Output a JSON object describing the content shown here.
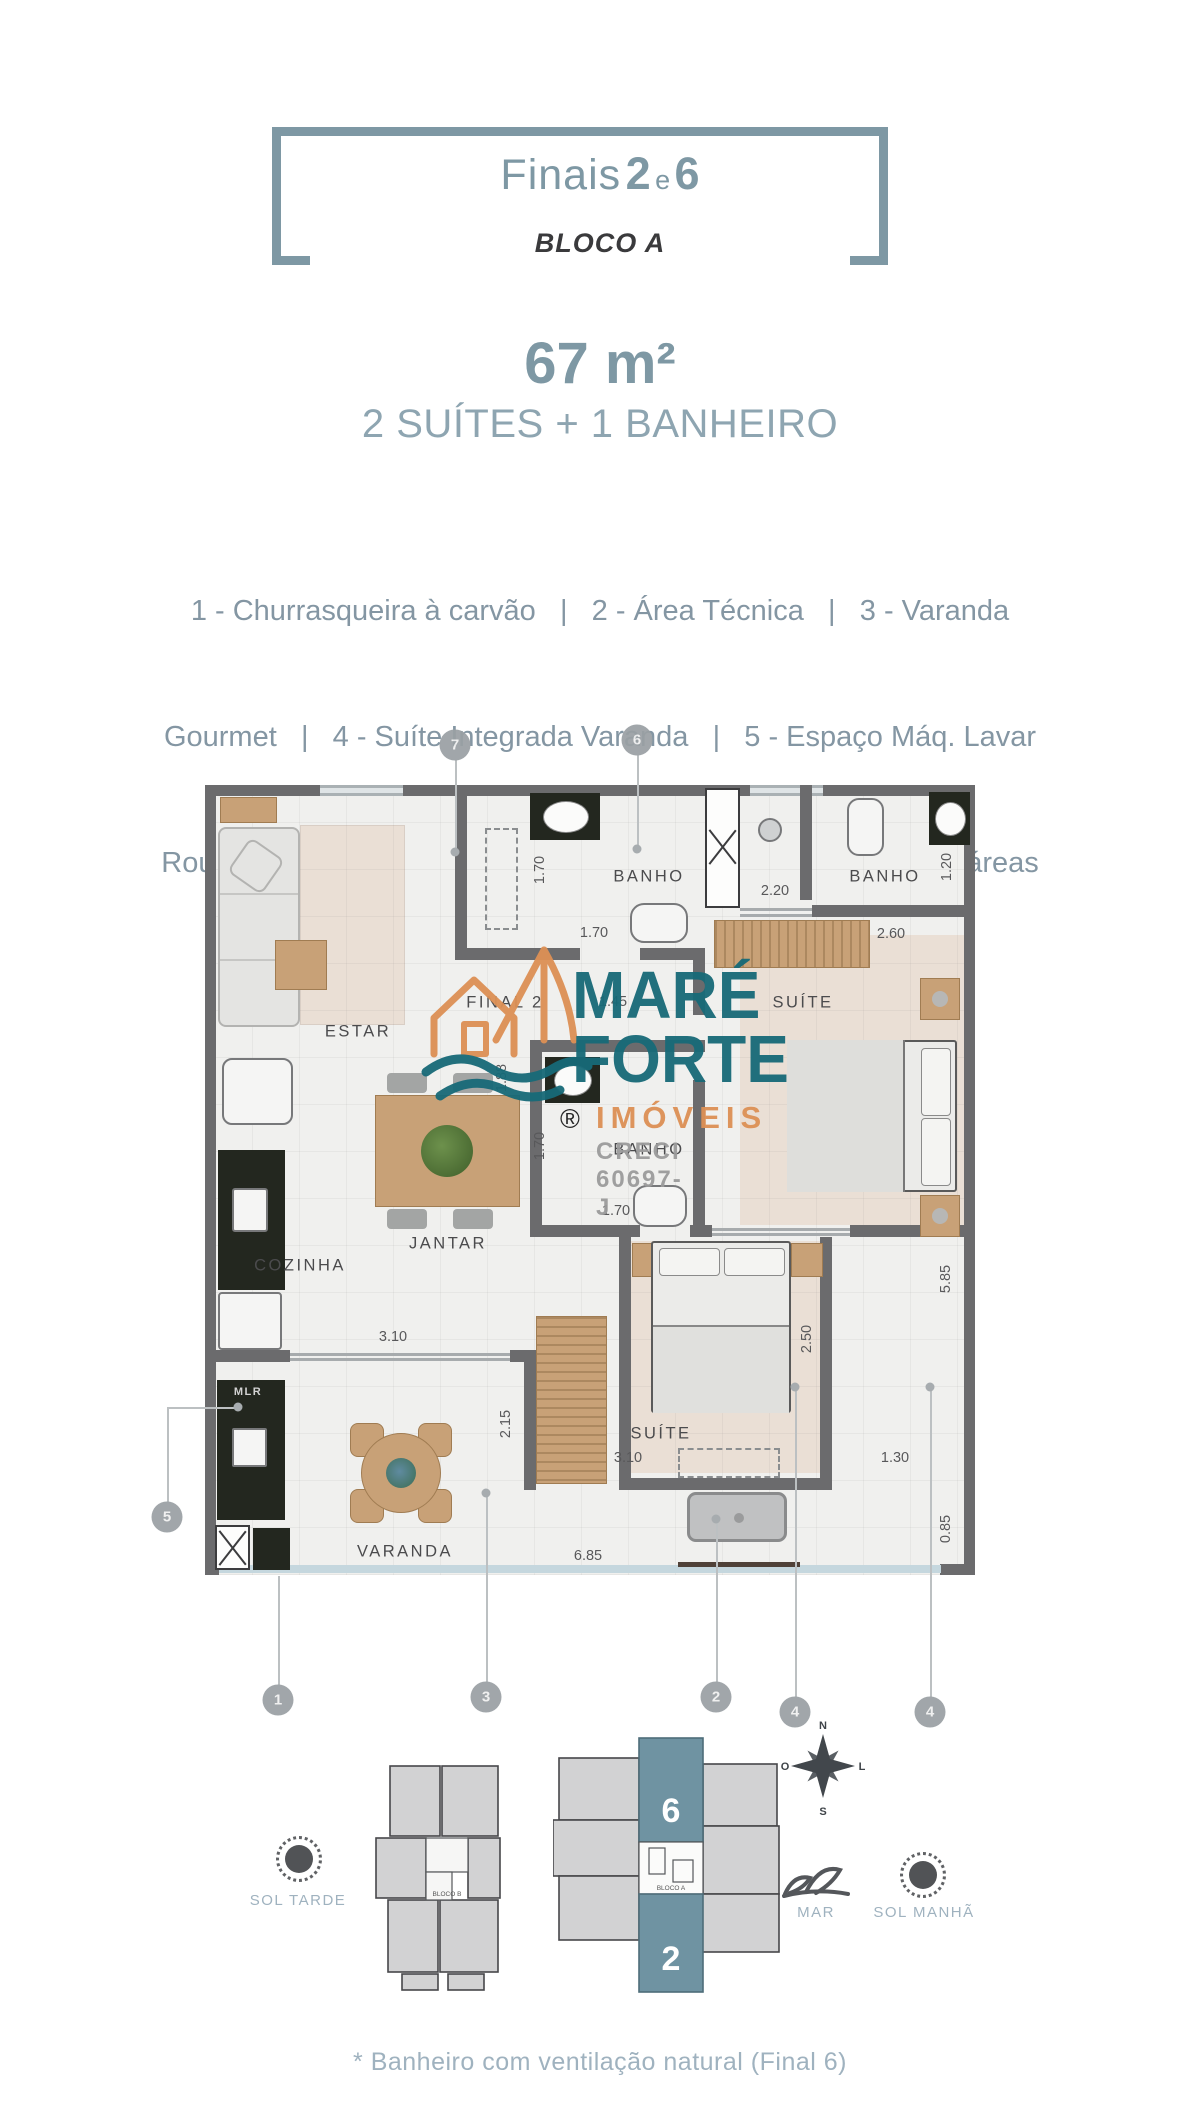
{
  "header": {
    "title_pre": "Finais",
    "title_n1": "2",
    "title_mid": "e",
    "title_n2": "6",
    "block": "BLOCO A",
    "area": "67 m²",
    "typology": "2 SUÍTES + 1 BANHEIRO",
    "accent_color": "#7e98a4"
  },
  "legend": {
    "lines": [
      "1 - Churrasqueira à carvão   |   2 - Área Técnica   |   3 - Varanda",
      "Gourmet   |   4 - Suíte Integrada Varanda   |   5 - Espaço Máq. Lavar",
      "Roupa | 6 - Banheiro Completo* | 7 - Porcelanato em todas as áreas"
    ]
  },
  "floorplan": {
    "rooms": [
      {
        "t": "ESTAR",
        "x": 358,
        "y": 1032
      },
      {
        "t": "BANHO",
        "x": 649,
        "y": 877
      },
      {
        "t": "BANHO",
        "x": 885,
        "y": 877
      },
      {
        "t": "SUÍTE",
        "x": 803,
        "y": 1003
      },
      {
        "t": "FINAL 2",
        "x": 505,
        "y": 1003
      },
      {
        "t": "BANHO",
        "x": 649,
        "y": 1150
      },
      {
        "t": "JANTAR",
        "x": 448,
        "y": 1244
      },
      {
        "t": "COZINHA",
        "x": 300,
        "y": 1266
      },
      {
        "t": "SUÍTE",
        "x": 661,
        "y": 1434
      },
      {
        "t": "VARANDA",
        "x": 405,
        "y": 1552
      },
      {
        "t": "MLR",
        "x": 248,
        "y": 1392,
        "k": "inv"
      }
    ],
    "dims": [
      {
        "t": "1.70",
        "x": 540,
        "y": 870,
        "v": 1
      },
      {
        "t": "1.70",
        "x": 594,
        "y": 933
      },
      {
        "t": "2.20",
        "x": 775,
        "y": 891
      },
      {
        "t": "1.20",
        "x": 947,
        "y": 867,
        "v": 1
      },
      {
        "t": "2.60",
        "x": 891,
        "y": 934
      },
      {
        "t": "1.45",
        "x": 613,
        "y": 1002
      },
      {
        "t": "1.88",
        "x": 502,
        "y": 1078,
        "v": 1
      },
      {
        "t": "1.70",
        "x": 540,
        "y": 1146,
        "v": 1
      },
      {
        "t": "1.70",
        "x": 616,
        "y": 1211
      },
      {
        "t": "3.10",
        "x": 393,
        "y": 1337
      },
      {
        "t": "2.15",
        "x": 506,
        "y": 1424,
        "v": 1
      },
      {
        "t": "3.10",
        "x": 628,
        "y": 1458
      },
      {
        "t": "1.30",
        "x": 895,
        "y": 1458
      },
      {
        "t": "2.50",
        "x": 807,
        "y": 1339,
        "v": 1
      },
      {
        "t": "5.85",
        "x": 946,
        "y": 1279,
        "v": 1
      },
      {
        "t": "0.85",
        "x": 946,
        "y": 1529,
        "v": 1
      },
      {
        "t": "6.85",
        "x": 588,
        "y": 1556
      }
    ],
    "callouts": [
      {
        "n": "7",
        "cx": 455,
        "cy": 745,
        "segs": [
          [
            455,
            760,
            455,
            852
          ]
        ],
        "dot": [
          455,
          852
        ]
      },
      {
        "n": "6",
        "cx": 637,
        "cy": 740,
        "segs": [
          [
            637,
            755,
            637,
            849
          ]
        ],
        "dot": [
          637,
          849
        ]
      },
      {
        "n": "5",
        "cx": 167,
        "cy": 1517,
        "segs": [
          [
            167,
            1407,
            167,
            1502
          ],
          [
            167,
            1407,
            238,
            1407
          ]
        ],
        "dot": [
          238,
          1407
        ]
      },
      {
        "n": "1",
        "cx": 278,
        "cy": 1700,
        "segs": [
          [
            278,
            1576,
            278,
            1685
          ]
        ]
      },
      {
        "n": "3",
        "cx": 486,
        "cy": 1697,
        "segs": [
          [
            486,
            1493,
            486,
            1682
          ]
        ],
        "dot": [
          486,
          1493
        ]
      },
      {
        "n": "2",
        "cx": 716,
        "cy": 1697,
        "segs": [
          [
            716,
            1519,
            716,
            1682
          ]
        ],
        "dot": [
          716,
          1519
        ]
      },
      {
        "n": "4",
        "cx": 795,
        "cy": 1712,
        "segs": [
          [
            795,
            1387,
            795,
            1697
          ]
        ],
        "dot": [
          795,
          1387
        ]
      },
      {
        "n": "4",
        "cx": 930,
        "cy": 1712,
        "segs": [
          [
            930,
            1387,
            930,
            1697
          ]
        ],
        "dot": [
          930,
          1387
        ]
      }
    ]
  },
  "logo": {
    "line1": "MARÉ",
    "line2": "FORTE",
    "line3": "IMÓVEIS",
    "registered": "®",
    "creci": "CRECI 60697-J",
    "teal": "#176a78",
    "orange": "#dd9055"
  },
  "siteplan": {
    "sol_tarde": "SOL TARDE",
    "mar": "MAR",
    "sol_manha": "SOL MANHÃ",
    "bloco_b": "BLOCO B",
    "bloco_a": "BLOCO A",
    "unit_top": "6",
    "unit_bottom": "2",
    "highlight_color": "#6f93a2",
    "compass": {
      "n": "N",
      "s": "S",
      "l": "L",
      "o": "O"
    }
  },
  "footer": {
    "note": "* Banheiro com ventilação natural (Final 6)"
  }
}
